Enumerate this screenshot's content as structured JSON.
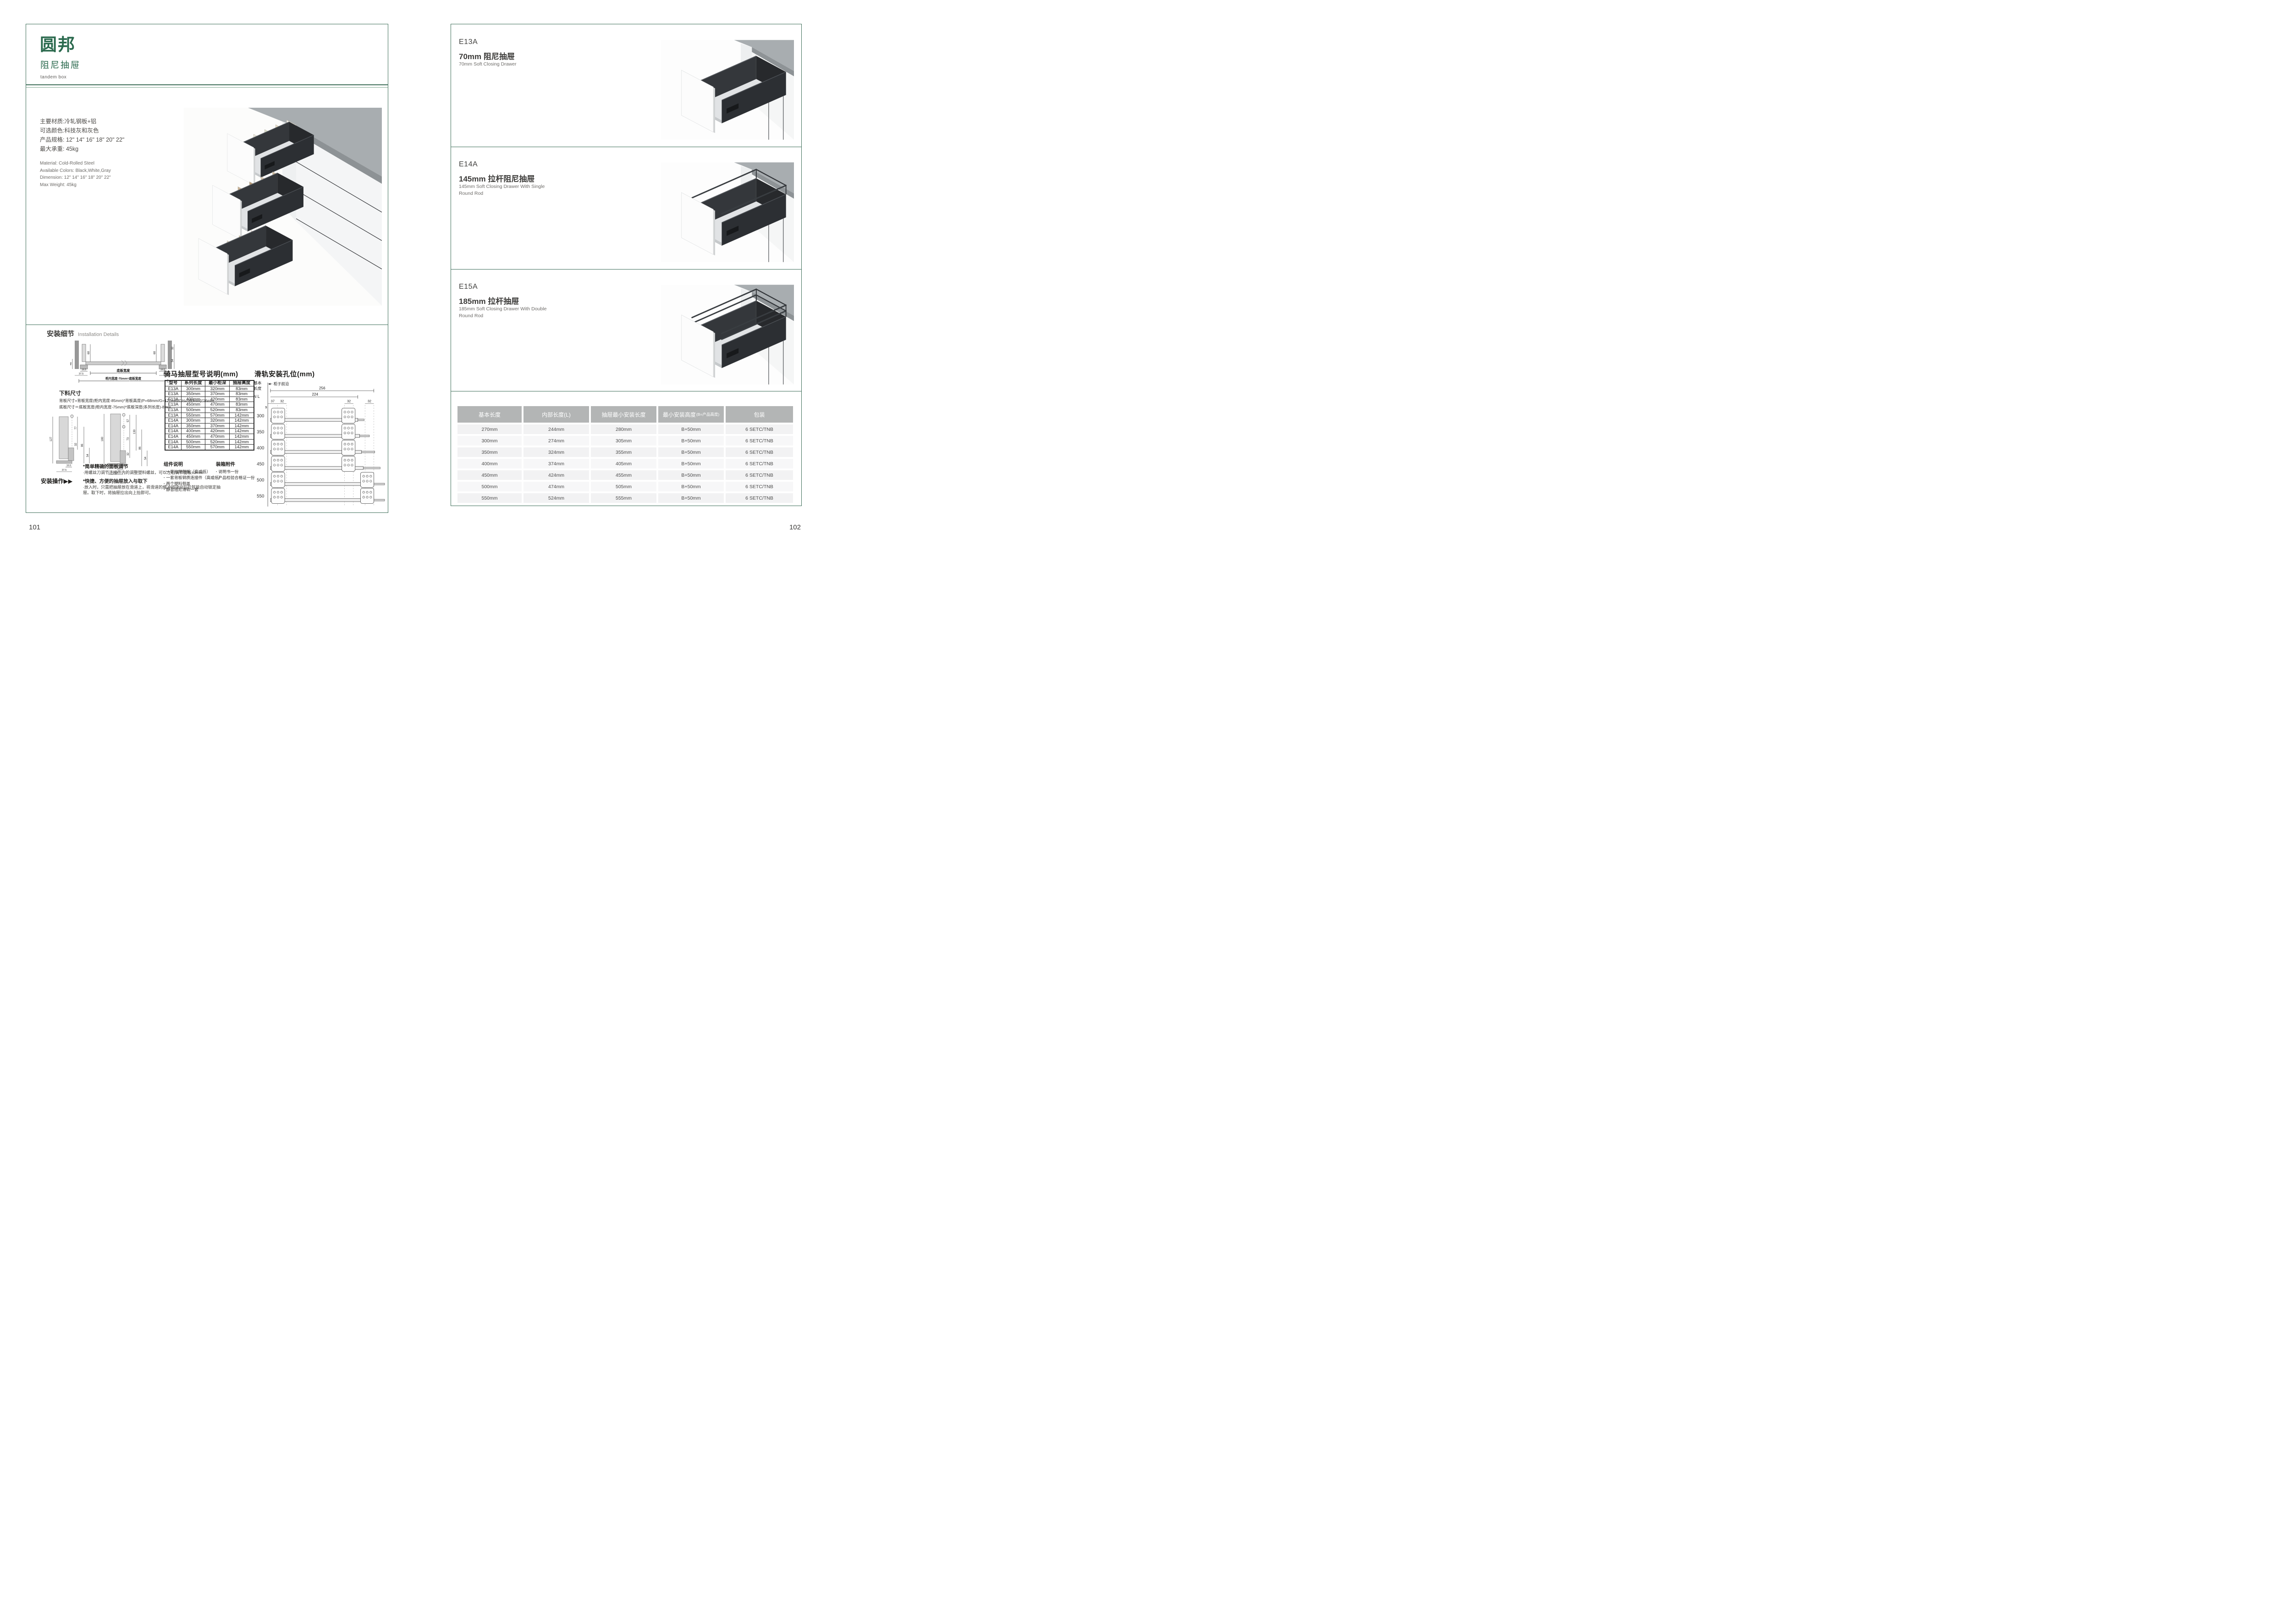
{
  "page_left": {
    "logo": "圆邦",
    "logo_sub": "阻尼抽屉",
    "logo_en": "tandem box",
    "page_number": "101",
    "specs_cn": [
      "主要材质:冷轧钢板+铝",
      "可选颜色:科技灰和灰色",
      "产品规格: 12\" 14\" 16\" 18\" 20\" 22\"",
      "最大承重: 45kg"
    ],
    "specs_en": [
      "Material: Cold-Rolled Steel",
      "Available Colors: Black,White,Gray",
      "Dimension: 12\" 14\" 16\" 18\" 20\" 22\"",
      "Max Weight: 45kg"
    ],
    "install": {
      "title_cn": "安装细节",
      "title_en": "Installation Details",
      "cutting_title": "下料尺寸",
      "formulas": [
        "背板尺寸=背板宽度(柜内宽度-85mm)*背板高度(P=68mm/G=127mm/GH=180mm)*16mm",
        "底板尺寸＝底板宽度(柜内宽度-75mm)*底板深度(系列长度)-8mm"
      ],
      "op_label": "安装操作",
      "op_arrows": "▶▶",
      "notes": [
        {
          "head": "*简单精确的面板调节",
          "body": "·用螺丝刀调节连接件内的调整塑料螺丝，可以左右调节面板±3mm"
        },
        {
          "head": "*快捷、方便的抽屉放入与取下",
          "body": "·放入时，只需把抽屉放在滑道上，将滑道的缓冲挡块向后拉就能自动锁定抽屉。取下时，将抽屉拉出向上抬即可。"
        }
      ]
    },
    "diagrams": {
      "d1": [
        "46",
        "68",
        "68",
        "32",
        "54",
        "16.5",
        "37.5",
        "16.5",
        "37.5",
        "底板宽度",
        "柜内宽度-75mm=底板宽度"
      ],
      "d2": [
        "127",
        "77",
        "32",
        "86",
        "54",
        "16.5",
        "37.5"
      ],
      "d3": [
        "180",
        "57",
        "73",
        "130",
        "32",
        "86",
        "54",
        "16.5",
        "37.5"
      ]
    },
    "model_table": {
      "title": "骑马抽屉型号说明(mm)",
      "headers": [
        "型号",
        "系列长度",
        "最小柜深",
        "抽屉高度"
      ],
      "rows": [
        [
          "E13A",
          "300mm",
          "320mm",
          "83mm"
        ],
        [
          "E13A",
          "350mm",
          "370mm",
          "83mm"
        ],
        [
          "E13A",
          "400mm",
          "420mm",
          "83mm"
        ],
        [
          "E13A",
          "450mm",
          "470mm",
          "83mm"
        ],
        [
          "E13A",
          "500mm",
          "520mm",
          "83mm"
        ],
        [
          "E13A",
          "550mm",
          "570mm",
          "142mm"
        ],
        [
          "E14A",
          "300mm",
          "320mm",
          "142mm"
        ],
        [
          "E14A",
          "350mm",
          "370mm",
          "142mm"
        ],
        [
          "E14A",
          "400mm",
          "420mm",
          "142mm"
        ],
        [
          "E14A",
          "450mm",
          "470mm",
          "142mm"
        ],
        [
          "E14A",
          "500mm",
          "520mm",
          "142mm"
        ],
        [
          "E14A",
          "550mm",
          "570mm",
          "142mm"
        ]
      ]
    },
    "rail": {
      "title": "滑轨安装孔位(mm)",
      "side_label": [
        "基本",
        "长度",
        "N L"
      ],
      "front_label": "柜子前沿",
      "dim_256": "256",
      "dim_224": "224",
      "dim_37": "37",
      "dim_9": "9",
      "dim_32": "32",
      "lengths": [
        "300",
        "350",
        "400",
        "450",
        "500",
        "550"
      ]
    },
    "components": {
      "title": "组件说明",
      "items": [
        "一套抽屉侧板（高或低）",
        "一套背板钢质连接件（高或低）",
        "两个塑料侧盖",
        "静音阻尼滑轨一套"
      ]
    },
    "packing": {
      "title": "装箱附件",
      "items": [
        "说明书一份",
        "产品检验合格证一份"
      ]
    }
  },
  "page_right": {
    "page_number": "102",
    "products": [
      {
        "model": "E13A",
        "name_cn": "70mm 阻尼抽屉",
        "name_en": "70mm Soft Closing Drawer",
        "rods": 0
      },
      {
        "model": "E14A",
        "name_cn": "145mm 拉杆阻尼抽屉",
        "name_en": "145mm Soft Closing Drawer With Single Round Rod",
        "rods": 1
      },
      {
        "model": "E15A",
        "name_cn": "185mm 拉杆抽屉",
        "name_en": "185mm Soft Closing Drawer With Double Round Rod",
        "rods": 2
      }
    ],
    "spec_table": {
      "headers": [
        {
          "label": "基本长度",
          "sub": ""
        },
        {
          "label": "内部长度(L)",
          "sub": ""
        },
        {
          "label": "抽屉最小安装长度",
          "sub": ""
        },
        {
          "label": "最小安装高度",
          "sub": "(B=产品高度)"
        },
        {
          "label": "包装",
          "sub": ""
        }
      ],
      "rows": [
        [
          "270mm",
          "244mm",
          "280mm",
          "B+50mm",
          "6 SETC/TNB"
        ],
        [
          "300mm",
          "274mm",
          "305mm",
          "B+50mm",
          "6 SETC/TNB"
        ],
        [
          "350mm",
          "324mm",
          "355mm",
          "B+50mm",
          "6 SETC/TNB"
        ],
        [
          "400mm",
          "374mm",
          "405mm",
          "B+50mm",
          "6 SETC/TNB"
        ],
        [
          "450mm",
          "424mm",
          "455mm",
          "B+50mm",
          "6 SETC/TNB"
        ],
        [
          "500mm",
          "474mm",
          "505mm",
          "B+50mm",
          "6 SETC/TNB"
        ],
        [
          "550mm",
          "524mm",
          "555mm",
          "B+50mm",
          "6 SETC/TNB"
        ]
      ]
    }
  },
  "colors": {
    "brand_green": "#2a694d",
    "frame_green": "#3f6f5a",
    "table_header_gray": "#b3b5b5",
    "row_gray": "#f2f2f3"
  }
}
